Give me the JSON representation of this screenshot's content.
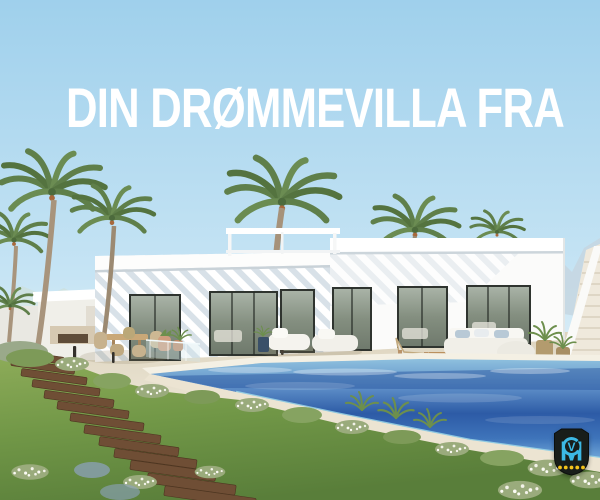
{
  "banner": {
    "headline": "DIN DRØMMEVILLA FRA"
  },
  "logo": {
    "monogram_outer": "M",
    "monogram_inner": "V",
    "dots_count": 5,
    "colors": {
      "shield": "#181d1a",
      "monogram": "#3cb8e4",
      "dots": "#f4c31c"
    }
  },
  "scene": {
    "colors": {
      "headline_text": "#ffffff",
      "sky_top": "#9fd0ec",
      "sky_horizon": "#e7f3f8",
      "villa_white": "#fbfbfa",
      "pool_deep": "#2d5ba6",
      "pool_light": "#8ec0de",
      "terrace": "#e6dfcd",
      "grass": "#6c9245",
      "palm_green": "#5f7f4a",
      "step_wood": "#6f4e35"
    }
  }
}
